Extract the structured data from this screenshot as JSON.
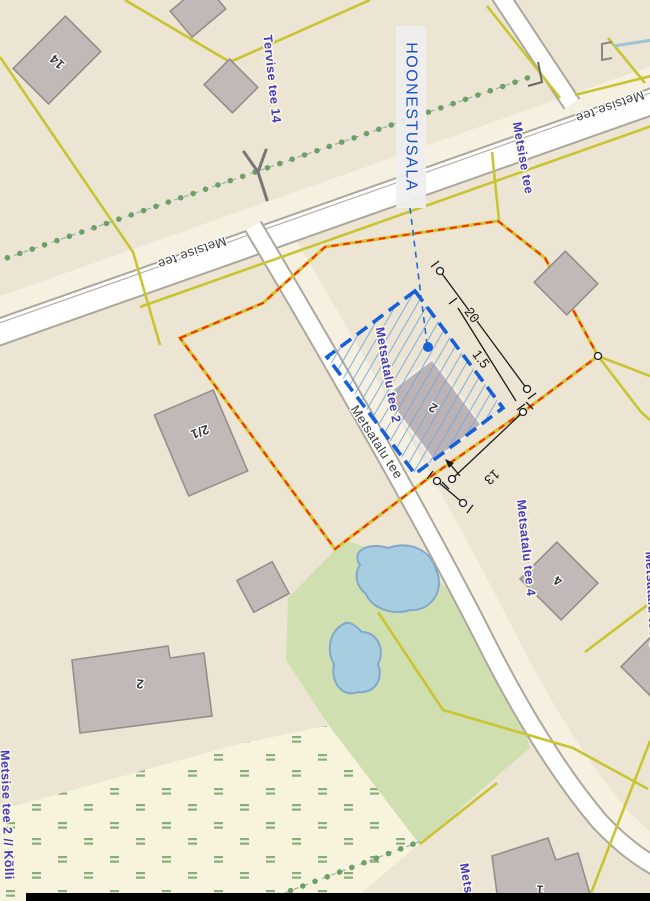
{
  "annotation": {
    "hoonestusala_label": "HOONESTUSALA"
  },
  "road_labels": {
    "metsise_tee_west": "Metsise tee",
    "metsise_tee_east": "Metsise tee",
    "metsatalu_tee": "Metsatalu tee"
  },
  "address_labels": {
    "tervise_tee_14": "Tervise tee 14",
    "metsise_tee": "Metsise tee",
    "metsatalu_tee_2": "Metsatalu tee 2",
    "metsatalu_tee_4": "Metsatalu tee 4",
    "metsatalu_tee_6": "Metsatalu tee 6",
    "metsise_tee_2_kolli": "Metsise tee 2 // Kõlli",
    "metsa_partial": "Metsa"
  },
  "building_numbers": {
    "b14": "14",
    "b2_1": "2/1",
    "b2_big": "2",
    "site_2": "2",
    "b4": "4",
    "b1": "1"
  },
  "dimensions": {
    "length": "20",
    "offset": "1.5",
    "side": "13"
  },
  "colors": {
    "background_beige": "#EDE5D3",
    "heath_pale": "#F7F3DC",
    "heath_mark_green": "#86AF7C",
    "grass_green": "#CFDFB0",
    "water_fill": "#A6CEE0",
    "water_edge": "#81A8CC",
    "parcel_yellow": "#C8C432",
    "planning_red": "#FF2A00",
    "hoonestusala_blue": "#1560D8",
    "hatch_blue": "#6FA8E0",
    "building_fill": "#C1B8B8",
    "building_edge": "#968C8C",
    "road_casing": "#ACA79C",
    "address_blue": "#4038C8",
    "tree_dot_green": "#6DA066"
  }
}
